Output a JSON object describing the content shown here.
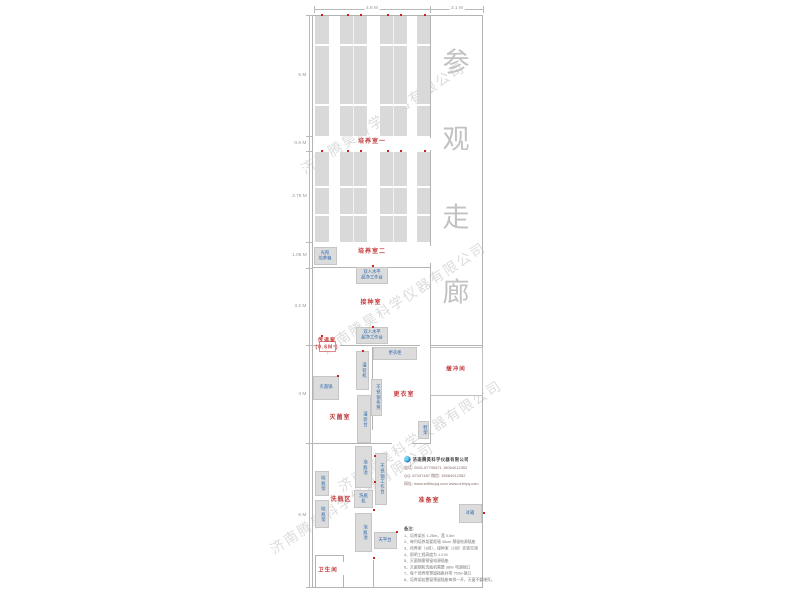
{
  "colors": {
    "room_label_red": "#c43c3c",
    "equipment_blue": "#2e6bad",
    "wall_gray": "#b3b3b3",
    "rack_gray": "#d9d9d9",
    "corridor_text_gray": "#c2c2c2",
    "power_dot_red": "#cf2020"
  },
  "dim_top": [
    {
      "label": "4.8 M",
      "cx": 372
    },
    {
      "label": "2.1 M",
      "cx": 457
    }
  ],
  "dim_left": [
    {
      "label": "5 M",
      "y": 75
    },
    {
      "label": "0.6 M",
      "y": 143
    },
    {
      "label": "3.75 M",
      "y": 196
    },
    {
      "label": "1.05 M",
      "y": 255
    },
    {
      "label": "3.2 M",
      "y": 306
    },
    {
      "label": "4 M",
      "y": 394
    },
    {
      "label": "6 M",
      "y": 515
    }
  ],
  "corridor": {
    "chars": [
      "参",
      "观",
      "走",
      "廊"
    ],
    "x": 456,
    "ys": [
      60,
      137,
      215,
      290
    ]
  },
  "rooms": [
    {
      "id": "culture-room-1-label",
      "label": "培养室一",
      "x": 372,
      "y": 143
    },
    {
      "id": "culture-room-2-label",
      "label": "培养室二",
      "x": 372,
      "y": 253
    },
    {
      "id": "inoculation-room-label",
      "label": "接种室",
      "x": 371,
      "y": 304
    },
    {
      "id": "pass-window-label",
      "label": "传递窗\n(0.6M²)",
      "x": 327,
      "y": 344,
      "fs": 5
    },
    {
      "id": "sterilization-room-label",
      "label": "灭菌室",
      "x": 340,
      "y": 419
    },
    {
      "id": "changing-room-label",
      "label": "更衣室",
      "x": 404,
      "y": 396
    },
    {
      "id": "buffer-room-label",
      "label": "缓冲间",
      "x": 456,
      "y": 370,
      "fs": 5.5
    },
    {
      "id": "bottle-washing-area-label",
      "label": "洗瓶区",
      "x": 341,
      "y": 501
    },
    {
      "id": "preparation-room-label",
      "label": "准备室",
      "x": 429,
      "y": 502
    },
    {
      "id": "bathroom-label",
      "label": "卫生间",
      "x": 328,
      "y": 571,
      "fs": 5.5
    }
  ],
  "equipment": [
    {
      "id": "light-incubator",
      "label": "光照\n培养箱",
      "x": 314,
      "y": 247,
      "w": 23,
      "h": 18,
      "dir": "h"
    },
    {
      "id": "clean-bench-1",
      "label": "双人水平\n超净工作台",
      "x": 356,
      "y": 267,
      "w": 32,
      "h": 17,
      "dir": "h"
    },
    {
      "id": "clean-bench-2",
      "label": "双人水平\n超净工作台",
      "x": 356,
      "y": 327,
      "w": 32,
      "h": 17,
      "dir": "h"
    },
    {
      "id": "changing-cabinet",
      "label": "更衣柜",
      "x": 373,
      "y": 347,
      "w": 44,
      "h": 13,
      "dir": "h"
    },
    {
      "id": "filling-machine",
      "label": "灌装机",
      "x": 356,
      "y": 351,
      "w": 13,
      "h": 39,
      "dir": "v"
    },
    {
      "id": "stainless-bench",
      "label": "不锈钢条凳",
      "x": 371,
      "y": 379,
      "w": 11,
      "h": 37,
      "dir": "v"
    },
    {
      "id": "filling-table",
      "label": "灌装台",
      "x": 357,
      "y": 395,
      "w": 14,
      "h": 48,
      "dir": "v"
    },
    {
      "id": "autoclave",
      "label": "灭菌锅",
      "x": 313,
      "y": 376,
      "w": 26,
      "h": 24,
      "dir": "h"
    },
    {
      "id": "shoe-rack",
      "label": "鞋架",
      "x": 418,
      "y": 421,
      "w": 11,
      "h": 18,
      "dir": "v"
    },
    {
      "id": "soak-pool-1",
      "label": "泡瓶池",
      "x": 355,
      "y": 446,
      "w": 17,
      "h": 42,
      "dir": "v"
    },
    {
      "id": "stainless-worktable",
      "label": "不锈钢工作台",
      "x": 375,
      "y": 453,
      "w": 12,
      "h": 52,
      "dir": "v"
    },
    {
      "id": "bottle-washer",
      "label": "洗瓶机",
      "x": 354,
      "y": 490,
      "w": 19,
      "h": 18,
      "dir": "h"
    },
    {
      "id": "bottle-drying-rack-1",
      "label": "晾瓶架",
      "x": 315,
      "y": 471,
      "w": 14,
      "h": 25,
      "dir": "v"
    },
    {
      "id": "bottle-drying-rack-2",
      "label": "晾瓶架",
      "x": 315,
      "y": 500,
      "w": 14,
      "h": 28,
      "dir": "v"
    },
    {
      "id": "soak-pool-2",
      "label": "泡瓶池",
      "x": 355,
      "y": 513,
      "w": 17,
      "h": 39,
      "dir": "v"
    },
    {
      "id": "balance-table",
      "label": "天平台",
      "x": 374,
      "y": 532,
      "w": 23,
      "h": 17,
      "dir": "h"
    },
    {
      "id": "refrigerator",
      "label": "冰箱",
      "x": 459,
      "y": 504,
      "w": 23,
      "h": 19,
      "dir": "h"
    }
  ],
  "racks": {
    "sections": [
      {
        "y": 16,
        "h": 120,
        "gaps": [
          44,
          104
        ]
      },
      {
        "y": 152,
        "h": 90,
        "gaps": [
          186,
          214
        ]
      }
    ],
    "columns": [
      {
        "x": 315,
        "w": 14,
        "split": false
      },
      {
        "x": 340,
        "w": 27,
        "split": true
      },
      {
        "x": 380,
        "w": 27,
        "split": true
      },
      {
        "x": 417,
        "w": 14,
        "split": false
      }
    ],
    "dot_xs": [
      321,
      347,
      360,
      387,
      400,
      424
    ]
  },
  "red_dots": [
    [
      372,
      265
    ],
    [
      372,
      326
    ],
    [
      362,
      350
    ],
    [
      337,
      375
    ],
    [
      321,
      335
    ],
    [
      374,
      455
    ],
    [
      374,
      481
    ],
    [
      373,
      509
    ],
    [
      373,
      557
    ],
    [
      483,
      512
    ],
    [
      396,
      531
    ]
  ],
  "watermarks": {
    "text": "济南腾昊科学仪器有限公司",
    "spots": [
      [
        383,
        118
      ],
      [
        404,
        298
      ],
      [
        420,
        436
      ],
      [
        352,
        498
      ]
    ]
  },
  "company": {
    "name": "济南腾昊科学仪器有限公司",
    "lines": [
      "电话: 0531-87790671  15064012352",
      "QQ: 87437487  微信: 15064012352",
      "网址: www.sdthkxyq.com  www.cnthyq.com"
    ]
  },
  "notes": {
    "title": "备注:",
    "items": [
      "1、培养架长 1.25m，宽 0.5m",
      "2、每列培养架要距墙 30cm 预留电源插座",
      "3、培养室（3间）、接种室（2间）安装空调",
      "4、照明工程高度为 1.0 M",
      "5、灭菌锅需预留电源插座",
      "6、灭菌锅和洗瓶机需要 380v 电源插口",
      "7、每个培养架预留插座并带 750w 插口",
      "8、培养架若靠窗预留插座每排一开，天窗不要堵死。"
    ]
  }
}
